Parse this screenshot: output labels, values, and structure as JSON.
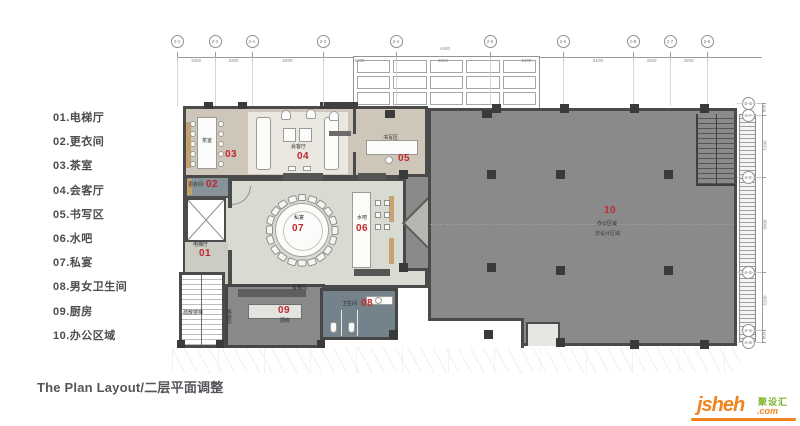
{
  "sheet": {
    "title": "The Plan Layout/二层平面调整"
  },
  "legend": {
    "items": [
      "01.电梯厅",
      "02.更衣间",
      "03.茶室",
      "04.会客厅",
      "05.书写区",
      "06.水吧",
      "07.私宴",
      "08.男女卫生间",
      "09.厨房",
      "10.办公区域"
    ]
  },
  "plan": {
    "room_labels": [
      {
        "num": "01",
        "numX": 199,
        "numY": 248,
        "name": "电梯厅",
        "nameX": 193,
        "nameY": 241
      },
      {
        "num": "02",
        "numX": 206,
        "numY": 179,
        "name": "更衣间",
        "nameX": 188,
        "nameY": 181
      },
      {
        "num": "03",
        "numX": 225,
        "numY": 149,
        "name": "茶室",
        "nameX": 202,
        "nameY": 137
      },
      {
        "num": "04",
        "numX": 297,
        "numY": 151,
        "name": "会客厅",
        "nameX": 291,
        "nameY": 143
      },
      {
        "num": "05",
        "numX": 398,
        "numY": 153,
        "name": "书写区",
        "nameX": 383,
        "nameY": 134
      },
      {
        "num": "06",
        "numX": 356,
        "numY": 223,
        "name": "水吧",
        "nameX": 357,
        "nameY": 214
      },
      {
        "num": "07",
        "numX": 292,
        "numY": 223,
        "name": "私宴",
        "nameX": 294,
        "nameY": 214
      },
      {
        "num": "08",
        "numX": 361,
        "numY": 298,
        "name": "卫生间",
        "nameX": 342,
        "nameY": 300
      },
      {
        "num": "09",
        "numX": 278,
        "numY": 305,
        "name": "厨房",
        "nameX": 280,
        "nameY": 317
      },
      {
        "num": "10",
        "numX": 604,
        "numY": 205,
        "name": "办公区域",
        "nameX": 597,
        "nameY": 220,
        "sub": "非设计区域",
        "subX": 595,
        "subY": 230
      }
    ],
    "extra_labels": [
      {
        "text": "备餐间",
        "x": 292,
        "y": 284,
        "rot": 0
      },
      {
        "text": "楼梯间",
        "x": 221,
        "y": 313,
        "rot": 90
      },
      {
        "text": "疏散楼梯",
        "x": 183,
        "y": 309,
        "rot": 0
      }
    ]
  },
  "grid": {
    "top": [
      {
        "label": "2-1",
        "x": 177
      },
      {
        "label": "2-2",
        "x": 215
      },
      {
        "label": "2-A",
        "x": 252
      },
      {
        "label": "2-3",
        "x": 323
      },
      {
        "label": "2-4",
        "x": 396
      },
      {
        "label": "2-5",
        "x": 490
      },
      {
        "label": "2-6",
        "x": 563
      },
      {
        "label": "2-B",
        "x": 633
      },
      {
        "label": "2-7",
        "x": 670
      },
      {
        "label": "2-8",
        "x": 707
      }
    ],
    "top_dims": [
      "3300",
      "3200",
      "6300",
      "6400",
      "8200",
      "6400",
      "6100",
      "3200",
      "3200"
    ],
    "top_total": "4400",
    "right": [
      {
        "label": "2-G",
        "y": 103
      },
      {
        "label": "2-F",
        "y": 115
      },
      {
        "label": "2-E",
        "y": 177
      },
      {
        "label": "2-D",
        "y": 272
      },
      {
        "label": "2-C",
        "y": 330
      },
      {
        "label": "2-B",
        "y": 342
      }
    ],
    "right_dims": [
      "800",
      "5100",
      "8000",
      "5100",
      "800"
    ]
  },
  "logo": {
    "word": "jsheh",
    "tld": ".com",
    "cn": "聚设汇"
  },
  "colors": {
    "label_red": "#c1272d",
    "logo_orange": "#f0831e",
    "logo_green": "#7db32b",
    "wing_floor": "#cdc6b9",
    "banquet_floor": "#d8dbd2",
    "office_floor": "#8a8a8a",
    "restroom_floor": "#74828c"
  }
}
